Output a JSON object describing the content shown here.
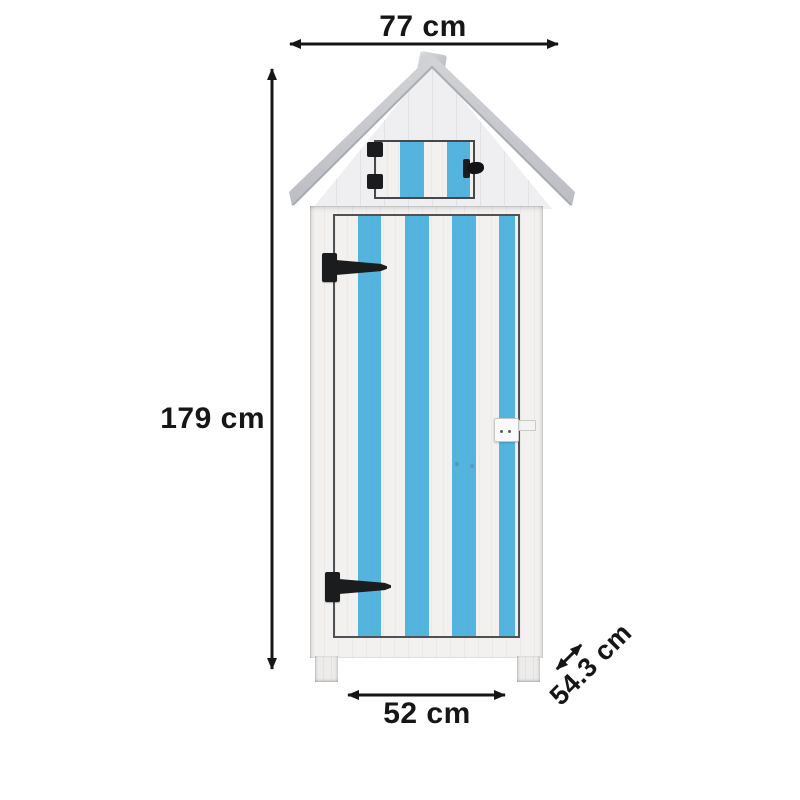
{
  "annotations": {
    "width": {
      "label": "77 cm",
      "value_cm": 77
    },
    "height": {
      "label": "179 cm",
      "value_cm": 179
    },
    "door_width": {
      "label": "52 cm",
      "value_cm": 52
    },
    "depth": {
      "label": "54.3 cm",
      "value_cm": 54.3
    }
  },
  "colors": {
    "stripe-blue": "#55b4de",
    "wood-white": "#f2f1ef",
    "gable-white": "#efeff1",
    "roof-gray": "#c7c9cd",
    "hardware-black": "#1b1c1e",
    "annotation-black": "#161616",
    "frame-line": "#4e5256"
  }
}
